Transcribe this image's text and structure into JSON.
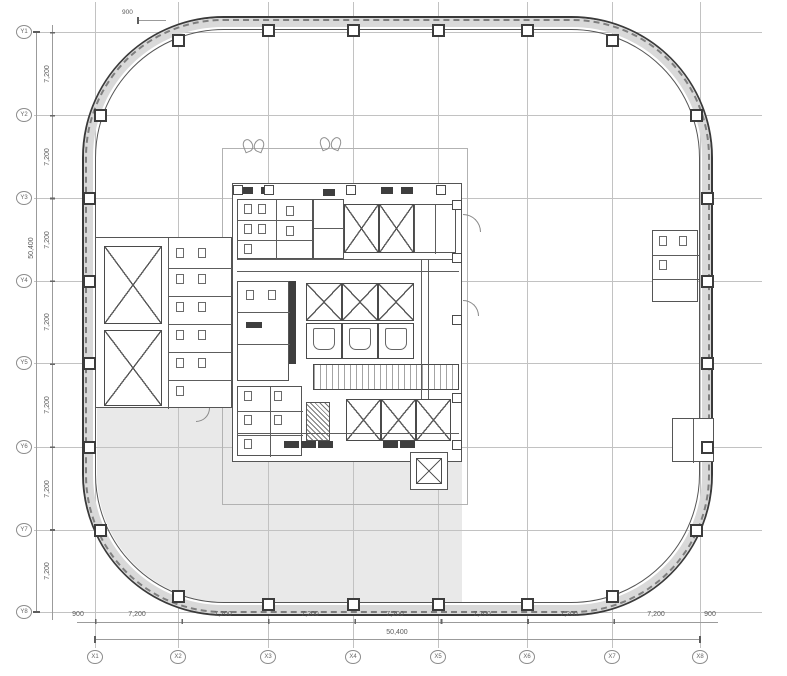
{
  "drawing": {
    "grid_bubbles_x": [
      "X1",
      "X2",
      "X3",
      "X4",
      "X5",
      "X6",
      "X7",
      "X8"
    ],
    "grid_bubbles_y": [
      "Y1",
      "Y2",
      "Y3",
      "Y4",
      "Y5",
      "Y6",
      "Y7",
      "Y8"
    ],
    "dim_bottom_bays": [
      "7,200",
      "7,200",
      "7,200",
      "7,200",
      "7,200",
      "7,200",
      "7,200"
    ],
    "dim_left_bays": [
      "7,200",
      "7,200",
      "7,200",
      "7,200",
      "7,200",
      "7,200",
      "7,200"
    ],
    "dim_bottom_total": "50,400",
    "dim_left_total": "50,400",
    "dim_edge_left": "900",
    "dim_edge_right": "900",
    "dim_note_topleft": "900",
    "colors": {
      "wall_line": "#3a3a3a",
      "wall_band": "#d9d9d9",
      "grid_line": "#c2c2c2",
      "floor_shade": "#e9e9e9",
      "linework": "#555555"
    }
  }
}
